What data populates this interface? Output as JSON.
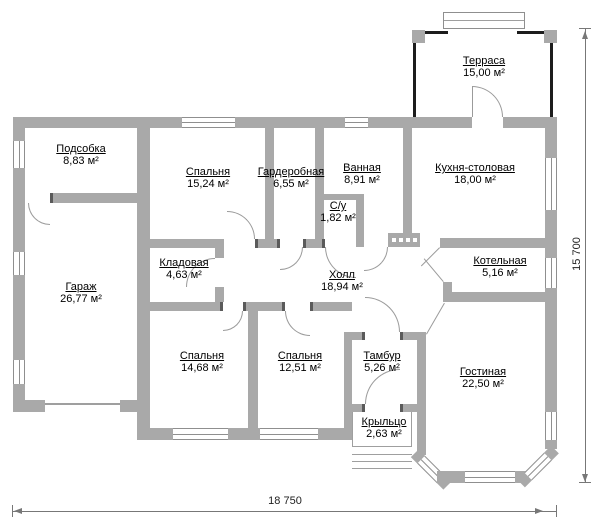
{
  "plan": {
    "rooms": [
      {
        "name": "Терраса",
        "area": "15,00 м²"
      },
      {
        "name": "Подсобка",
        "area": "8,83 м²"
      },
      {
        "name": "Спальня",
        "area": "15,24 м²"
      },
      {
        "name": "Гардеробная",
        "area": "6,55 м²"
      },
      {
        "name": "Ванная",
        "area": "8,91 м²"
      },
      {
        "name": "С/у",
        "area": "1,82 м²"
      },
      {
        "name": "Кухня-столовая",
        "area": "18,00 м²"
      },
      {
        "name": "Гараж",
        "area": "26,77 м²"
      },
      {
        "name": "Кладовая",
        "area": "4,63 м²"
      },
      {
        "name": "Холл",
        "area": "18,94 м²"
      },
      {
        "name": "Котельная",
        "area": "5,16 м²"
      },
      {
        "name": "Спальня",
        "area": "14,68 м²"
      },
      {
        "name": "Спальня",
        "area": "12,51 м²"
      },
      {
        "name": "Тамбур",
        "area": "5,26 м²"
      },
      {
        "name": "Гостиная",
        "area": "22,50 м²"
      },
      {
        "name": "Крыльцо",
        "area": "2,63 м²"
      }
    ],
    "dimensions": {
      "width": "18 750",
      "height": "15 700"
    },
    "colors": {
      "wall": "#a9a9a9",
      "terrace_wall": "#1c1c1c",
      "line": "#8f8f8f",
      "text": "#000000"
    }
  }
}
